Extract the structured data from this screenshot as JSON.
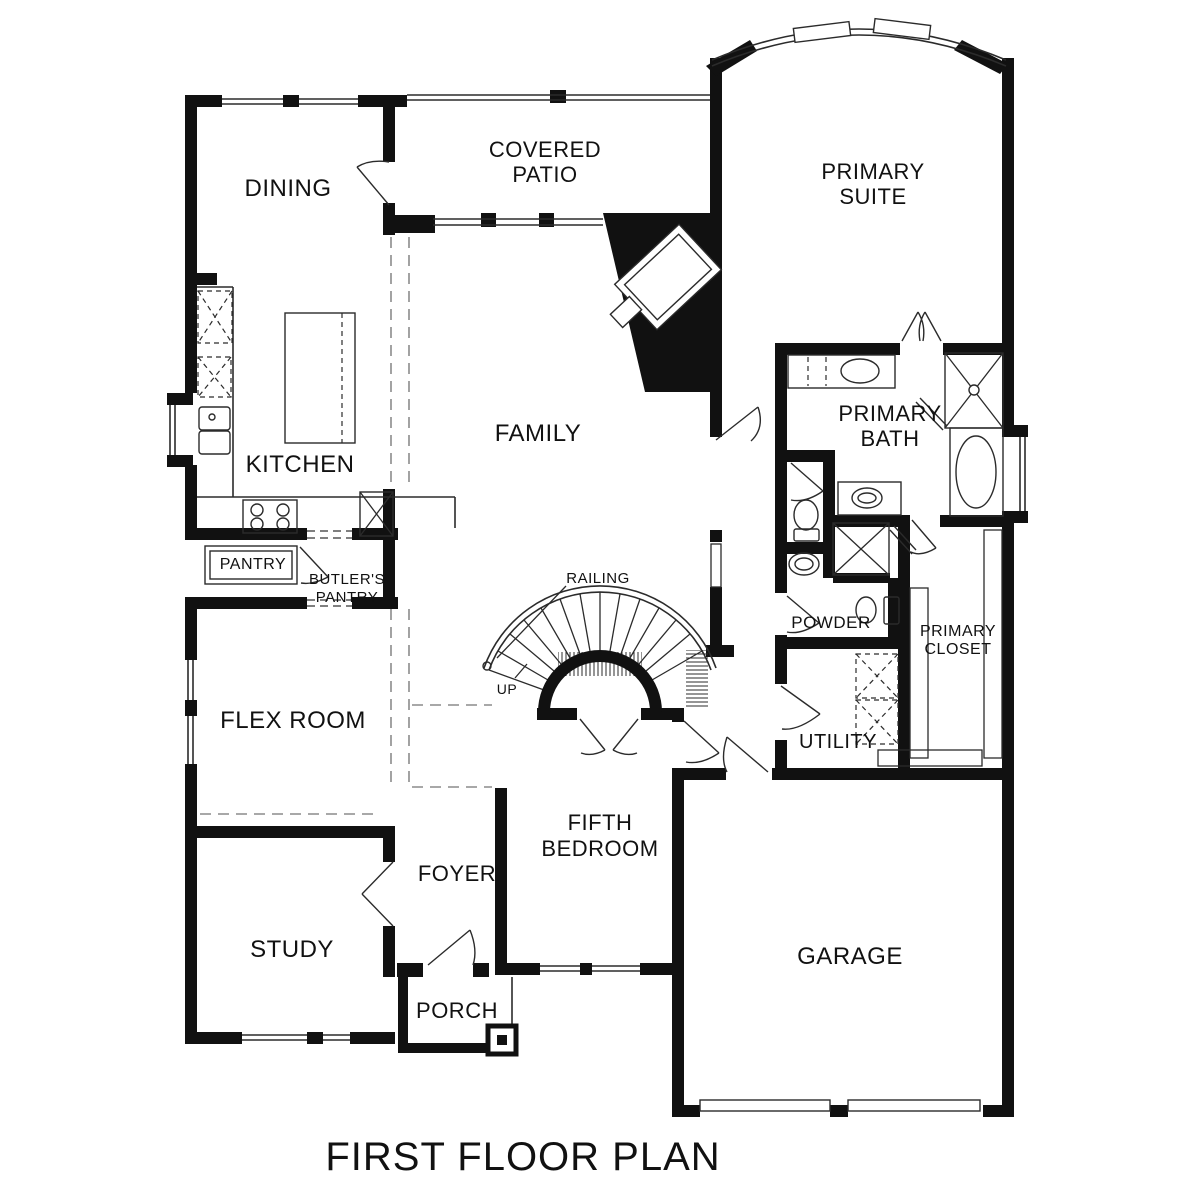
{
  "title": "FIRST FLOOR PLAN",
  "labels": {
    "dining": "DINING",
    "covered_patio": [
      "COVERED",
      "PATIO"
    ],
    "primary_suite": [
      "PRIMARY",
      "SUITE"
    ],
    "family": "FAMILY",
    "kitchen": "KITCHEN",
    "primary_bath": [
      "PRIMARY",
      "BATH"
    ],
    "pantry": "PANTRY",
    "butlers_pantry": [
      "BUTLER'S",
      "PANTRY"
    ],
    "flex_room": "FLEX ROOM",
    "railing": "RAILING",
    "up": "UP",
    "powder": "POWDER",
    "primary_closet": [
      "PRIMARY",
      "CLOSET"
    ],
    "utility": "UTILITY",
    "fifth_bedroom": [
      "FIFTH",
      "BEDROOM"
    ],
    "foyer": "FOYER",
    "study": "STUDY",
    "porch": "PORCH",
    "garage": "GARAGE"
  },
  "colors": {
    "wall": "#111111",
    "line": "#2b2b2b",
    "ceiling_break_dash": "#8c8c8c",
    "background": "#ffffff"
  }
}
